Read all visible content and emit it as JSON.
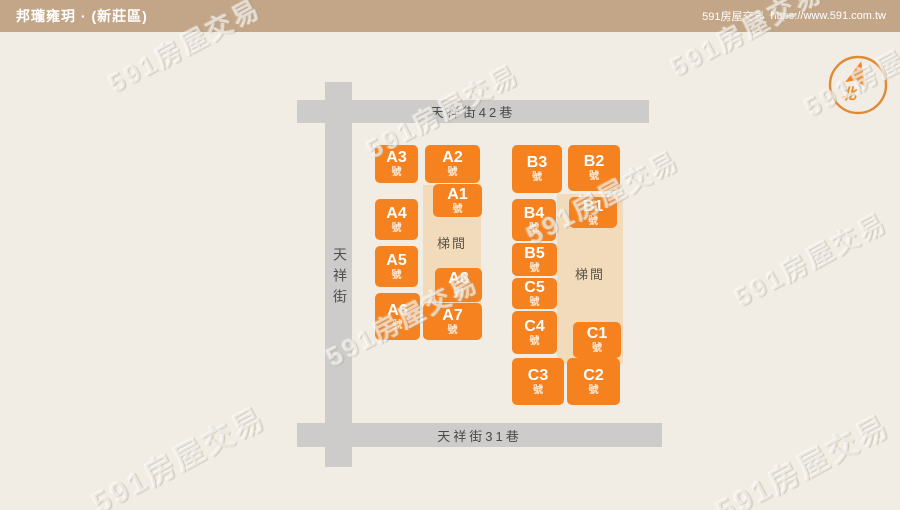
{
  "header": {
    "title": "邦瓏雍玥 · (新莊區)",
    "site_name": "591房屋交易",
    "site_url": "https://www.591.com.tw"
  },
  "compass": {
    "north_label": "北"
  },
  "streets": {
    "top": "天祥街42巷",
    "bottom": "天祥街31巷",
    "left": "天祥街"
  },
  "map": {
    "stair_label": "梯間",
    "unit_suffix": "號",
    "units": [
      {
        "id": "A3",
        "label": "A3"
      },
      {
        "id": "A2",
        "label": "A2"
      },
      {
        "id": "A1",
        "label": "A1"
      },
      {
        "id": "A4",
        "label": "A4"
      },
      {
        "id": "A5",
        "label": "A5"
      },
      {
        "id": "A8",
        "label": "A8"
      },
      {
        "id": "A6",
        "label": "A6"
      },
      {
        "id": "A7",
        "label": "A7"
      },
      {
        "id": "B3",
        "label": "B3"
      },
      {
        "id": "B2",
        "label": "B2"
      },
      {
        "id": "B4",
        "label": "B4"
      },
      {
        "id": "B1",
        "label": "B1"
      },
      {
        "id": "B5",
        "label": "B5"
      },
      {
        "id": "C5",
        "label": "C5"
      },
      {
        "id": "C4",
        "label": "C4"
      },
      {
        "id": "C1",
        "label": "C1"
      },
      {
        "id": "C3",
        "label": "C3"
      },
      {
        "id": "C2",
        "label": "C2"
      }
    ]
  },
  "watermark": {
    "text": "591房屋交易"
  },
  "colors": {
    "accent_orange": "#F5821F",
    "street_gray": "#CDCCCA",
    "core_beige": "#F1DBBB",
    "header_tan": "#C2A687",
    "background_cream": "#F2EDE4",
    "compass_orange": "#E08A35"
  }
}
